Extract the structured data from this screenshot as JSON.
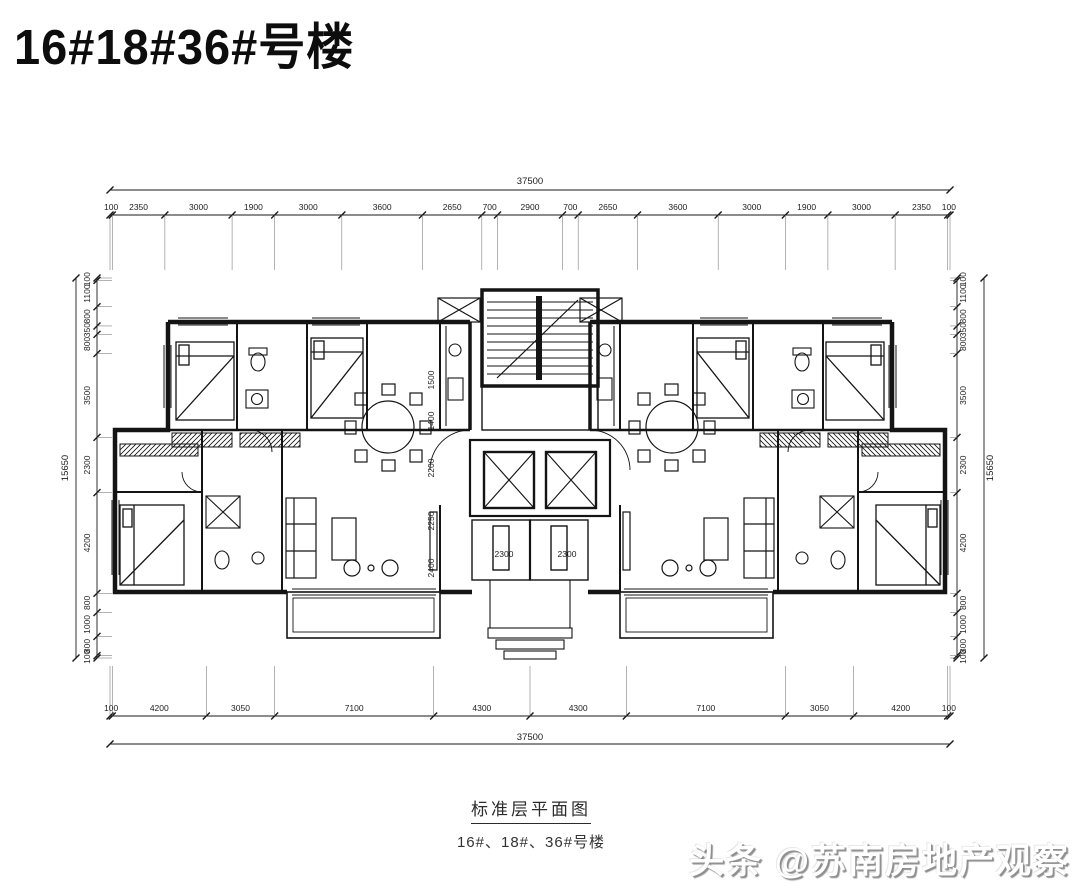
{
  "title": "16#18#36#号楼",
  "plan": {
    "caption_title": "标准层平面图",
    "caption_subtitle": "16#、18#、36#号楼",
    "dims": {
      "top_total": "37500",
      "top_segments": [
        100,
        2350,
        3000,
        1900,
        3000,
        3600,
        2650,
        700,
        2900,
        700,
        2650,
        3600,
        3000,
        1900,
        3000,
        2350,
        100
      ],
      "bottom_total": "37500",
      "bottom_segments": [
        100,
        4200,
        3050,
        7100,
        4300,
        4300,
        7100,
        3050,
        4200,
        100
      ],
      "left_total": "15650",
      "left_segments": [
        100,
        1100,
        800,
        350,
        800,
        3500,
        2300,
        4200,
        800,
        1000,
        800,
        100
      ],
      "right_total": "15650",
      "right_segments": [
        100,
        1100,
        800,
        350,
        800,
        3500,
        2300,
        4200,
        800,
        1000,
        800,
        100
      ],
      "interior": [
        {
          "text": "1500",
          "x": 434,
          "y": 380,
          "rot": true
        },
        {
          "text": "1400",
          "x": 434,
          "y": 421,
          "rot": true
        },
        {
          "text": "2200",
          "x": 434,
          "y": 468,
          "rot": true
        },
        {
          "text": "2250",
          "x": 434,
          "y": 521,
          "rot": true
        },
        {
          "text": "2400",
          "x": 434,
          "y": 568,
          "rot": true
        },
        {
          "text": "2300",
          "x": 504,
          "y": 557,
          "rot": false
        },
        {
          "text": "2300",
          "x": 567,
          "y": 557,
          "rot": false
        }
      ]
    }
  },
  "watermark": {
    "text": "头条 @苏南房地产观察"
  },
  "colors": {
    "line": "#1a1a1a",
    "background": "#ffffff",
    "watermark_shadow": "#8f8f8f"
  }
}
